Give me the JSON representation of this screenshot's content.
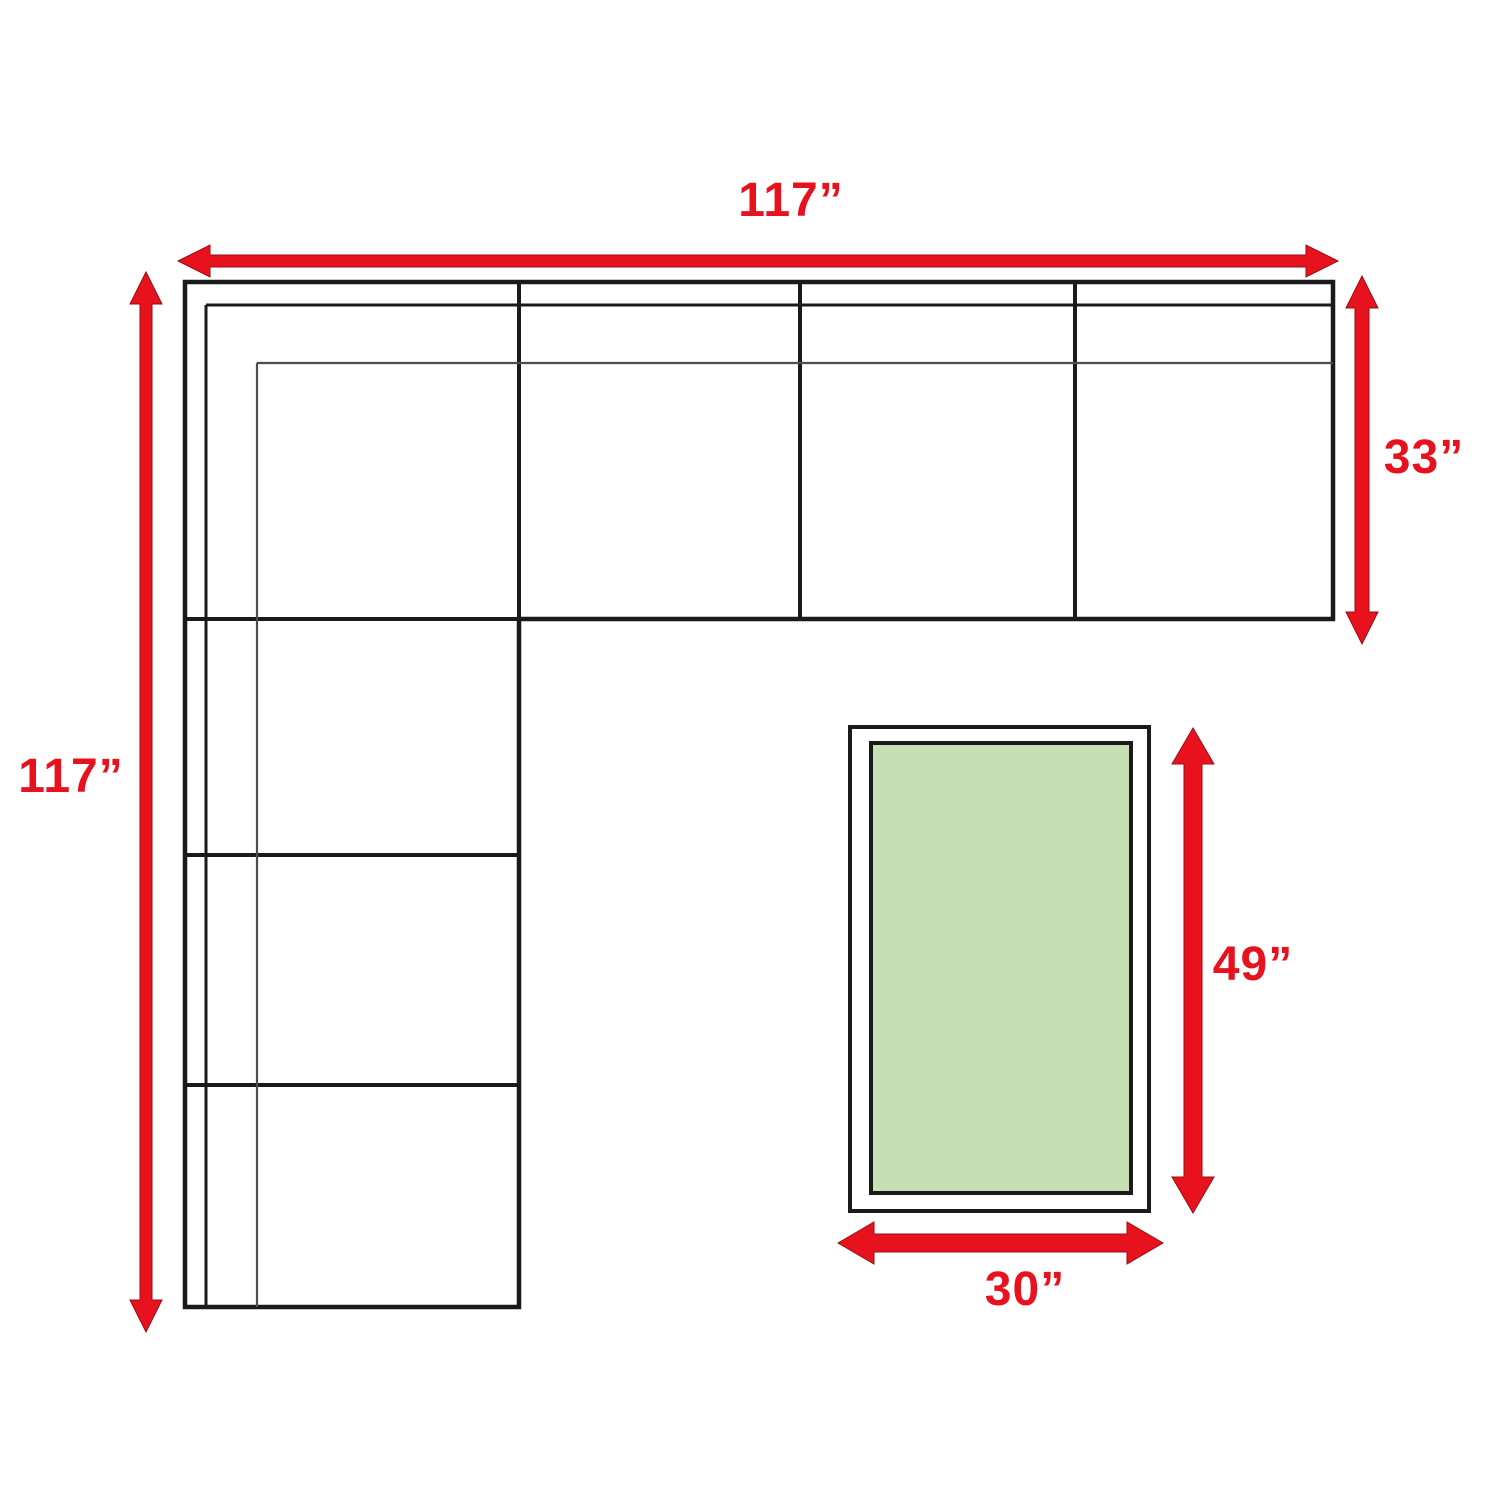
{
  "diagram": {
    "kind": "furniture-dimension-floorplan",
    "items": [
      "sectional-sofa",
      "coffee-table"
    ]
  },
  "dimensions": {
    "sofa_width_top": {
      "label": "117”",
      "value_inches": 117
    },
    "sofa_depth_left": {
      "label": "117”",
      "value_inches": 117
    },
    "section_depth_right": {
      "label": "33”",
      "value_inches": 33
    },
    "table_length_right": {
      "label": "49”",
      "value_inches": 49
    },
    "table_width_bottom": {
      "label": "30”",
      "value_inches": 30
    }
  },
  "colors": {
    "dimension_red": "#e8121f",
    "table_green_fill": "#c6dfb4",
    "line_black": "#1a1a1a",
    "line_gray": "#4d4d4d",
    "page_background": "#ffffff"
  }
}
